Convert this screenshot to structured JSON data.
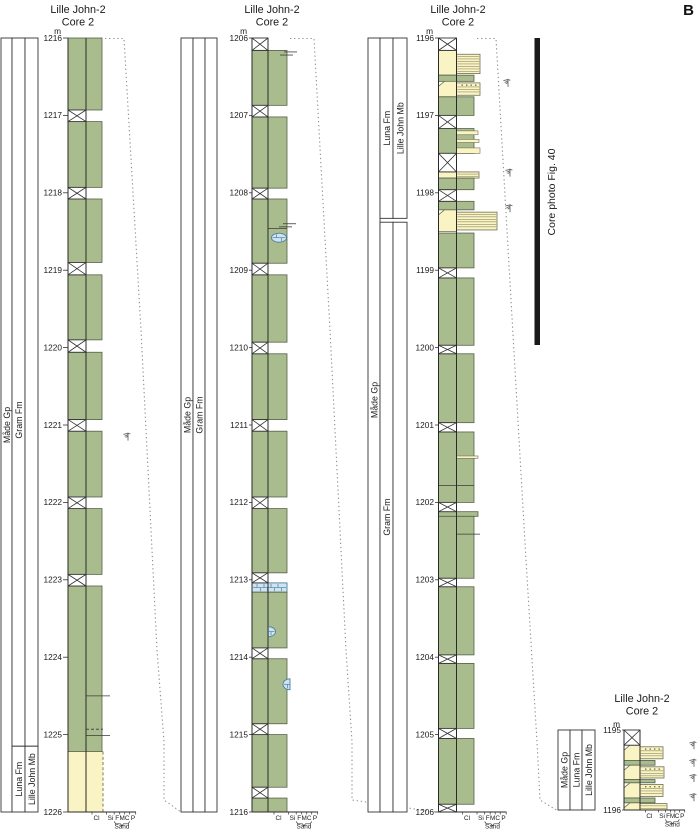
{
  "figure_label": "B",
  "core_photo": {
    "label": "Core photo Fig. 40",
    "bar": {
      "x": 534.5,
      "y": 38,
      "w": 5.5,
      "h": 307
    },
    "label_pos": {
      "x": 552,
      "y": 192
    }
  },
  "grain_scale": {
    "labels": [
      "Cl",
      "Si",
      "F",
      "M",
      "C",
      "P"
    ],
    "sand_label": "Sand"
  },
  "colors": {
    "mud": "#a9bc8e",
    "mud_border": "#555f49",
    "sand": "#faf3c3",
    "sand_border": "#6f6f52",
    "lam_line": "#8f8f66",
    "dot": "#77774f",
    "carb": "#cfe4f0",
    "carb_border": "#4d7f9e",
    "ink": "#1a1a1a",
    "grid": "#333333",
    "corr": "#8f8f8f",
    "trace": "#666666",
    "bar": "#1a1a1a"
  },
  "corr_lines": [
    {
      "points": [
        [
          105,
          38.5
        ],
        [
          124,
          38.5
        ],
        [
          141,
          330
        ],
        [
          157,
          650
        ],
        [
          164,
          742
        ],
        [
          164,
          800
        ],
        [
          181,
          812
        ]
      ]
    },
    {
      "points": [
        [
          290,
          38.5
        ],
        [
          314,
          38.5
        ],
        [
          330,
          330
        ],
        [
          346,
          650
        ],
        [
          352,
          742
        ],
        [
          352,
          800
        ],
        [
          436,
          812
        ]
      ]
    },
    {
      "points": [
        [
          477,
          38.5
        ],
        [
          496,
          38.5
        ],
        [
          511,
          300
        ],
        [
          526,
          560
        ],
        [
          537,
          742
        ],
        [
          540,
          800
        ],
        [
          558,
          811
        ]
      ]
    }
  ],
  "columns": [
    {
      "id": "core2-1216-1226",
      "title": [
        "Lille John-2",
        "Core 2"
      ],
      "title_cx": 78,
      "title_y": 13,
      "m_label": "m",
      "depth_top": 1216,
      "depth_bottom": 1226,
      "y_top": 38,
      "y_bottom": 812,
      "x": {
        "label_right": 62,
        "track_left": 68,
        "clay": 86,
        "green_right": 102
      },
      "depth_labels": [
        1216,
        1217,
        1218,
        1219,
        1220,
        1221,
        1222,
        1223,
        1224,
        1225,
        1226
      ],
      "strips": [
        {
          "x": 1,
          "w": 11,
          "boxes": [
            {
              "from": 1216,
              "to": 1226,
              "label": "Måde Gp",
              "label_y": 425
            }
          ]
        },
        {
          "x": 12,
          "w": 13,
          "boxes": [
            {
              "from": 1216,
              "to": 1225.15,
              "label": "Gram Fm",
              "label_y": 420
            },
            {
              "from": 1225.15,
              "to": 1226,
              "label": "Luna Fm"
            }
          ]
        },
        {
          "x": 25,
          "w": 13,
          "boxes": [
            {
              "from": 1216,
              "to": 1225.15,
              "label": ""
            },
            {
              "from": 1225.15,
              "to": 1226,
              "label": "Lille John Mb"
            }
          ]
        }
      ],
      "units": [
        {
          "type": "mud",
          "from": 1216.0,
          "to": 1216.93
        },
        {
          "type": "mud",
          "from": 1217.08,
          "to": 1217.93
        },
        {
          "type": "mud",
          "from": 1218.08,
          "to": 1218.9
        },
        {
          "type": "mud",
          "from": 1219.06,
          "to": 1219.9
        },
        {
          "type": "mud",
          "from": 1220.06,
          "to": 1220.93
        },
        {
          "type": "mud",
          "from": 1221.08,
          "to": 1221.93
        },
        {
          "type": "mud",
          "from": 1222.08,
          "to": 1222.93
        },
        {
          "type": "mud",
          "from": 1223.08,
          "to": 1225.22
        },
        {
          "type": "sand_full",
          "from": 1225.22,
          "to": 1226.0,
          "right": 103
        }
      ],
      "gaps": [
        [
          1216.93,
          1217.08
        ],
        [
          1217.93,
          1218.08
        ],
        [
          1218.9,
          1219.06
        ],
        [
          1219.9,
          1220.06
        ],
        [
          1220.93,
          1221.08
        ],
        [
          1221.93,
          1222.08
        ],
        [
          1222.93,
          1223.08
        ]
      ],
      "lines": [
        {
          "at": 1224.5,
          "x1": 86,
          "x2": 110
        },
        {
          "at": 1224.93,
          "x1": 86,
          "x2": 103,
          "dash": true
        },
        {
          "at": 1225.01,
          "x1": 86,
          "x2": 110
        }
      ],
      "symbols": [
        {
          "kind": "trace",
          "x": 128,
          "at": 1221.15
        }
      ]
    },
    {
      "id": "core2-1206-1216",
      "title": [
        "Lille John-2",
        "Core 2"
      ],
      "title_cx": 272,
      "title_y": 13,
      "m_label": "m",
      "depth_top": 1206,
      "depth_bottom": 1216,
      "y_top": 38,
      "y_bottom": 812,
      "x": {
        "label_right": 248,
        "track_left": 252,
        "clay": 268,
        "green_right": 287
      },
      "depth_labels": [
        1206,
        1207,
        1208,
        1209,
        1210,
        1211,
        1212,
        1213,
        1214,
        1215,
        1216
      ],
      "strips": [
        {
          "x": 181,
          "w": 12,
          "boxes": [
            {
              "from": 1206,
              "to": 1216,
              "label": "Måde Gp",
              "label_y": 415
            }
          ]
        },
        {
          "x": 193,
          "w": 12,
          "boxes": [
            {
              "from": 1206,
              "to": 1216,
              "label": "Gram Fm",
              "label_y": 415
            }
          ]
        },
        {
          "x": 205,
          "w": 12,
          "boxes": [
            {
              "from": 1206,
              "to": 1216,
              "label": ""
            }
          ]
        }
      ],
      "units": [
        {
          "type": "mud",
          "from": 1206.16,
          "to": 1206.87
        },
        {
          "type": "mud",
          "from": 1207.02,
          "to": 1207.94
        },
        {
          "type": "mud",
          "from": 1208.08,
          "to": 1208.91
        },
        {
          "type": "mud",
          "from": 1209.06,
          "to": 1209.93
        },
        {
          "type": "mud",
          "from": 1210.08,
          "to": 1210.93
        },
        {
          "type": "mud",
          "from": 1211.08,
          "to": 1211.93
        },
        {
          "type": "mud",
          "from": 1212.08,
          "to": 1212.91
        },
        {
          "type": "carb_band",
          "from": 1213.04,
          "to": 1213.16
        },
        {
          "type": "mud",
          "from": 1213.16,
          "to": 1213.88
        },
        {
          "type": "mud",
          "from": 1214.02,
          "to": 1214.86
        },
        {
          "type": "mud",
          "from": 1215.0,
          "to": 1215.68
        },
        {
          "type": "mud",
          "from": 1215.82,
          "to": 1216.0
        }
      ],
      "gaps": [
        [
          1206.0,
          1206.16
        ],
        [
          1206.87,
          1207.02
        ],
        [
          1207.94,
          1208.08
        ],
        [
          1208.91,
          1209.06
        ],
        [
          1209.93,
          1210.08
        ],
        [
          1210.93,
          1211.08
        ],
        [
          1211.93,
          1212.08
        ],
        [
          1212.91,
          1213.04
        ],
        [
          1213.88,
          1214.02
        ],
        [
          1214.86,
          1215.0
        ],
        [
          1215.68,
          1215.82
        ]
      ],
      "lines": [
        {
          "at": 1206.18,
          "x1": 284,
          "x2": 297
        },
        {
          "at": 1206.22,
          "x1": 280,
          "x2": 293
        },
        {
          "at": 1208.4,
          "x1": 283,
          "x2": 296
        },
        {
          "at": 1208.44,
          "x1": 279,
          "x2": 292
        },
        {
          "at": 1208.46,
          "x1": 268,
          "x2": 287
        }
      ],
      "symbols": [
        {
          "kind": "conc",
          "shape": "full",
          "x": 279,
          "at": 1208.58,
          "rx": 7.5,
          "ry": 4.5
        },
        {
          "kind": "conc",
          "shape": "halfR",
          "x": 268.5,
          "at": 1213.67,
          "rx": 7,
          "ry": 5
        },
        {
          "kind": "conc",
          "shape": "halfL",
          "x": 290,
          "at": 1214.35,
          "rx": 7,
          "ry": 5.5
        }
      ]
    },
    {
      "id": "core2-1196-1206",
      "title": [
        "Lille John-2",
        "Core 2"
      ],
      "title_cx": 458,
      "title_y": 13,
      "m_label": "m",
      "depth_top": 1196,
      "depth_bottom": 1206,
      "y_top": 38,
      "y_bottom": 812,
      "x": {
        "label_right": 434,
        "track_left": 438.5,
        "clay": 456.5,
        "green_right": 474
      },
      "depth_labels": [
        1196,
        1197,
        1198,
        1199,
        1200,
        1201,
        1202,
        1203,
        1204,
        1205,
        1206
      ],
      "strips": [
        {
          "x": 368,
          "w": 12,
          "boxes": [
            {
              "from": 1196,
              "to": 1206,
              "label": "Måde Gp",
              "label_y": 400
            }
          ]
        },
        {
          "x": 380,
          "w": 13,
          "boxes": [
            {
              "from": 1196,
              "to": 1198.33,
              "label": "Luna Fm"
            },
            {
              "from": 1198.38,
              "to": 1206,
              "label": "Gram Fm"
            }
          ]
        },
        {
          "x": 393,
          "w": 14,
          "boxes": [
            {
              "from": 1196,
              "to": 1198.33,
              "label": "Lille John Mb"
            },
            {
              "from": 1198.38,
              "to": 1206,
              "label": ""
            }
          ]
        }
      ],
      "units": [
        {
          "type": "sandbed",
          "from": 1196.16,
          "to": 1196.48,
          "block_from": 1196.21,
          "block_to": 1196.46,
          "right": 480,
          "dots": false,
          "bevel": false
        },
        {
          "type": "mud",
          "from": 1196.48,
          "to": 1196.56
        },
        {
          "type": "sandbed",
          "from": 1196.56,
          "to": 1196.76,
          "block_from": 1196.58,
          "block_to": 1196.74,
          "right": 480,
          "dots": true,
          "bevel": true
        },
        {
          "type": "mud",
          "from": 1196.76,
          "to": 1197.0
        },
        {
          "type": "mud",
          "from": 1197.17,
          "to": 1197.49
        },
        {
          "type": "sand_stringer",
          "from": 1197.2,
          "to": 1197.25,
          "right": 478
        },
        {
          "type": "sand_stringer",
          "from": 1197.31,
          "to": 1197.35,
          "right": 479
        },
        {
          "type": "sand_stringer",
          "from": 1197.42,
          "to": 1197.49,
          "right": 480
        },
        {
          "type": "sandbed",
          "from": 1197.73,
          "to": 1197.81,
          "block_from": 1197.73,
          "block_to": 1197.81,
          "right": 479,
          "dots": false,
          "bevel": false
        },
        {
          "type": "mud",
          "from": 1197.81,
          "to": 1197.96
        },
        {
          "type": "mud",
          "from": 1198.11,
          "to": 1198.22
        },
        {
          "type": "sandbed",
          "from": 1198.22,
          "to": 1198.5,
          "block_from": 1198.25,
          "block_to": 1198.48,
          "right": 497,
          "dots": false,
          "bevel": true
        },
        {
          "type": "mud",
          "from": 1198.52,
          "to": 1198.97
        },
        {
          "type": "mud",
          "from": 1199.1,
          "to": 1199.97
        },
        {
          "type": "mud",
          "from": 1200.08,
          "to": 1200.97
        },
        {
          "type": "mud",
          "from": 1201.09,
          "to": 1202.0
        },
        {
          "type": "sand_stringer",
          "from": 1201.4,
          "to": 1201.43,
          "right": 478
        },
        {
          "type": "mud",
          "from": 1202.12,
          "to": 1202.18,
          "right": 478
        },
        {
          "type": "mud",
          "from": 1202.18,
          "to": 1202.98
        },
        {
          "type": "mud",
          "from": 1203.09,
          "to": 1203.97
        },
        {
          "type": "mud",
          "from": 1204.08,
          "to": 1204.92
        },
        {
          "type": "mud",
          "from": 1205.05,
          "to": 1205.9
        }
      ],
      "gaps": [
        [
          1196.0,
          1196.16
        ],
        [
          1197.0,
          1197.17
        ],
        [
          1197.49,
          1197.73
        ],
        [
          1197.96,
          1198.11
        ],
        [
          1198.97,
          1199.1
        ],
        [
          1199.97,
          1200.08
        ],
        [
          1200.97,
          1201.09
        ],
        [
          1202.0,
          1202.12
        ],
        [
          1202.98,
          1203.09
        ],
        [
          1203.97,
          1204.08
        ],
        [
          1204.92,
          1205.05
        ],
        [
          1205.9,
          1206.0
        ]
      ],
      "lines": [
        {
          "at": 1201.78,
          "x1": 438.5,
          "x2": 474
        },
        {
          "at": 1202.41,
          "x1": 456.5,
          "x2": 480
        }
      ],
      "symbols": [
        {
          "kind": "trace",
          "x": 508,
          "at": 1196.58
        },
        {
          "kind": "trace",
          "x": 510,
          "at": 1197.74
        },
        {
          "kind": "trace",
          "x": 510,
          "at": 1198.2
        }
      ]
    },
    {
      "id": "core2-1195-1196",
      "title": [
        "Lille John-2",
        "Core 2"
      ],
      "title_cx": 642,
      "title_y": 702,
      "m_label": "m",
      "m_y": 727,
      "scale_k": 0.9,
      "depth_top": 1195,
      "depth_bottom": 1196,
      "y_top": 730,
      "y_bottom": 810,
      "x": {
        "label_right": 621,
        "track_left": 624,
        "clay": 640,
        "green_right": 655
      },
      "depth_labels": [
        1195,
        1196
      ],
      "strips": [
        {
          "x": 558,
          "w": 12,
          "boxes": [
            {
              "from": 1195,
              "to": 1196,
              "label": "Måde Gp"
            }
          ]
        },
        {
          "x": 570,
          "w": 12,
          "boxes": [
            {
              "from": 1195,
              "to": 1196,
              "label": "Luna Fm"
            }
          ]
        },
        {
          "x": 582,
          "w": 13,
          "boxes": [
            {
              "from": 1195,
              "to": 1196,
              "label": "Lille John Mb"
            }
          ]
        }
      ],
      "units": [
        {
          "type": "sandbed",
          "from": 1195.19,
          "to": 1195.38,
          "block_from": 1195.21,
          "block_to": 1195.36,
          "right": 663,
          "dots": true,
          "bevel": true
        },
        {
          "type": "mud",
          "from": 1195.38,
          "to": 1195.44
        },
        {
          "type": "sandbed",
          "from": 1195.44,
          "to": 1195.62,
          "block_from": 1195.46,
          "block_to": 1195.6,
          "right": 664,
          "dots": true,
          "bevel": true
        },
        {
          "type": "mud",
          "from": 1195.62,
          "to": 1195.66
        },
        {
          "type": "sandbed",
          "from": 1195.66,
          "to": 1195.85,
          "block_from": 1195.68,
          "block_to": 1195.83,
          "right": 663,
          "dots": true,
          "bevel": true
        },
        {
          "type": "mud",
          "from": 1195.85,
          "to": 1195.91
        },
        {
          "type": "sandbed",
          "from": 1195.91,
          "to": 1196.0,
          "block_from": 1195.92,
          "block_to": 1196.0,
          "right": 667,
          "dots": false,
          "bevel": true
        }
      ],
      "gaps": [
        [
          1195.0,
          1195.19
        ]
      ],
      "lines": [],
      "symbols": [
        {
          "kind": "trace",
          "x": 694,
          "at": 1195.19
        },
        {
          "kind": "trace",
          "x": 694,
          "at": 1195.41
        },
        {
          "kind": "trace",
          "x": 694,
          "at": 1195.6
        },
        {
          "kind": "trace",
          "x": 694,
          "at": 1195.84
        }
      ]
    }
  ]
}
